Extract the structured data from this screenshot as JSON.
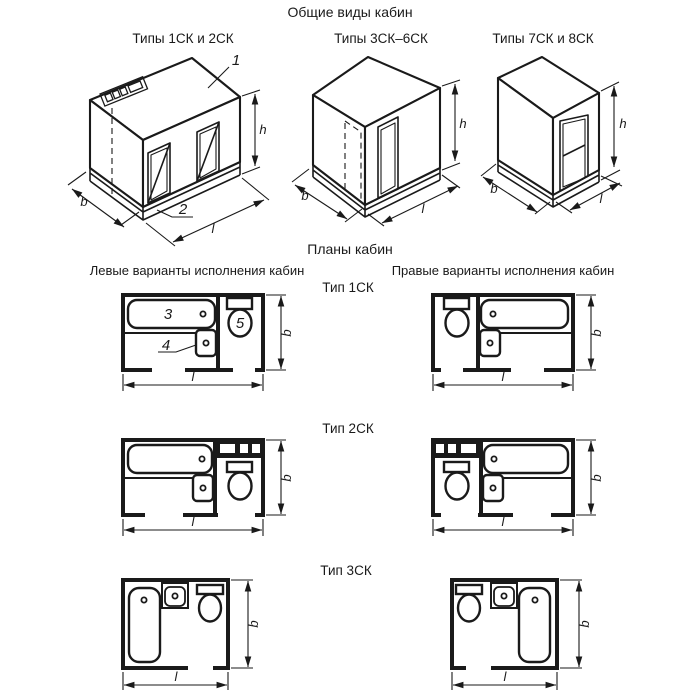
{
  "titles": {
    "views": "Общие виды кабин",
    "plans": "Планы кабин",
    "left_variants": "Левые варианты исполнения кабин",
    "right_variants": "Правые варианты исполнения кабин"
  },
  "view_labels": {
    "v1": "Типы 1СК и 2СК",
    "v2": "Типы 3СК–6СК",
    "v3": "Типы 7СК и 8СК"
  },
  "plan_labels": {
    "p1": "Тип 1СК",
    "p2": "Тип 2СК",
    "p3": "Тип 3СК"
  },
  "dims": {
    "h": "h",
    "b": "b",
    "l": "l"
  },
  "callouts": {
    "c1": "1",
    "c2": "2",
    "c3": "3",
    "c4": "4",
    "c5": "5"
  },
  "colors": {
    "ink": "#1a1a1a",
    "paper": "#ffffff"
  }
}
